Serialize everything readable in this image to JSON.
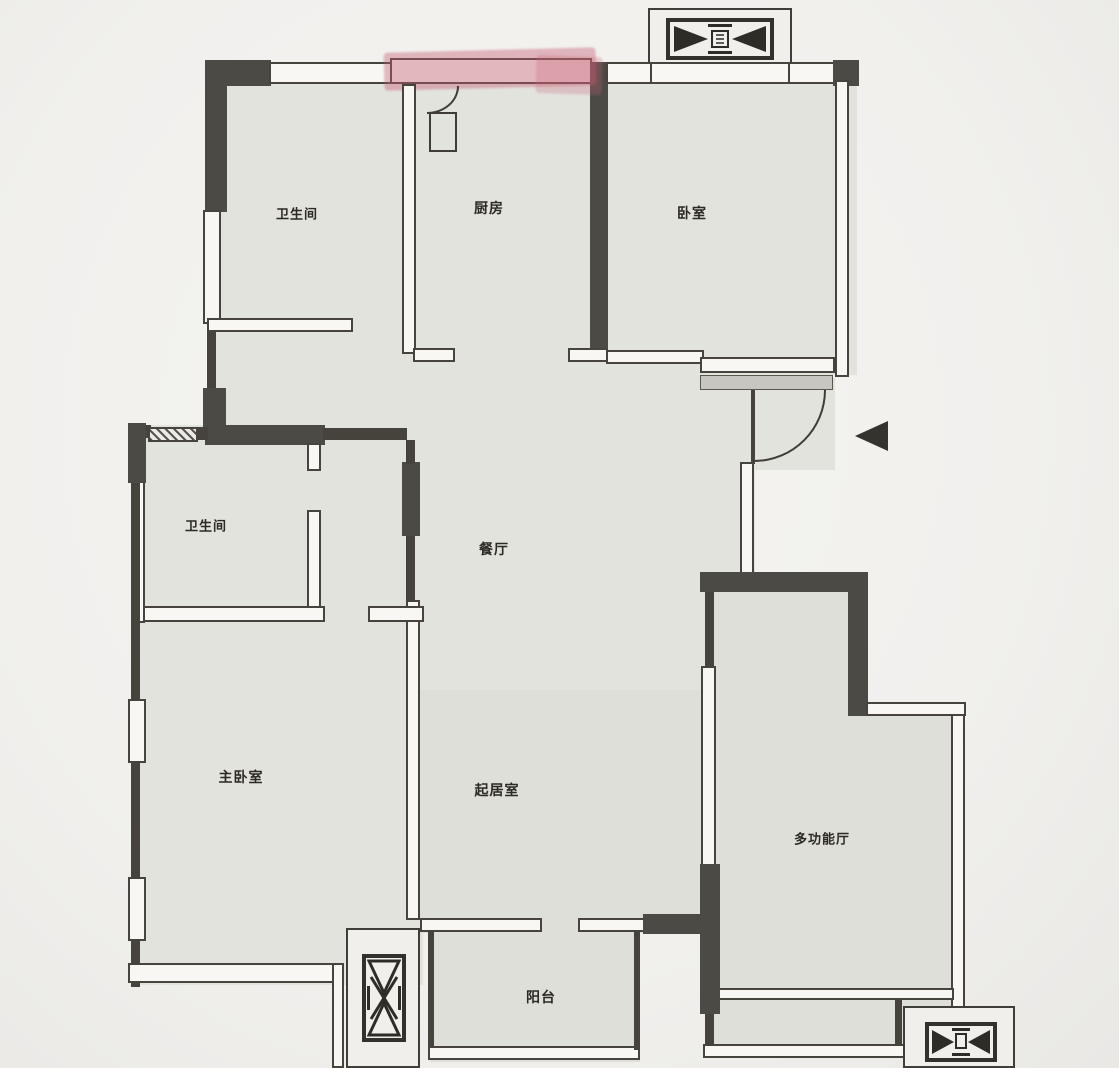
{
  "plan": {
    "type": "apartment-floor-plan",
    "rooms": [
      {
        "id": "bathroom-top-left",
        "label": "卫生间"
      },
      {
        "id": "kitchen",
        "label": "厨房"
      },
      {
        "id": "bedroom-top-right",
        "label": "卧室"
      },
      {
        "id": "bathroom-middle-left",
        "label": "卫生间"
      },
      {
        "id": "dining-room",
        "label": "餐厅"
      },
      {
        "id": "master-bedroom",
        "label": "主卧室"
      },
      {
        "id": "living-room",
        "label": "起居室"
      },
      {
        "id": "multi-function-hall",
        "label": "多功能厅"
      },
      {
        "id": "balcony",
        "label": "阳台"
      }
    ],
    "icons": [
      {
        "name": "elevator-icon-top"
      },
      {
        "name": "elevator-icon-bottom-left"
      },
      {
        "name": "elevator-icon-bottom-right"
      },
      {
        "name": "entry-direction-triangle"
      },
      {
        "name": "door-swing-arc-kitchen"
      },
      {
        "name": "door-swing-arc-entry"
      }
    ],
    "annotations": [
      {
        "name": "red-highlighter-mark",
        "location": "top exterior wall / window band"
      }
    ],
    "colors": {
      "background": "#f3f2ef",
      "floor": "#e3e3de",
      "wall": "#45433b",
      "wall_dark": "#4c4a44",
      "window_band": "#f8f7f4",
      "threshold": "#c7c6c1",
      "highlight_red": "#c05a70",
      "label_text": "#2b2921"
    }
  }
}
